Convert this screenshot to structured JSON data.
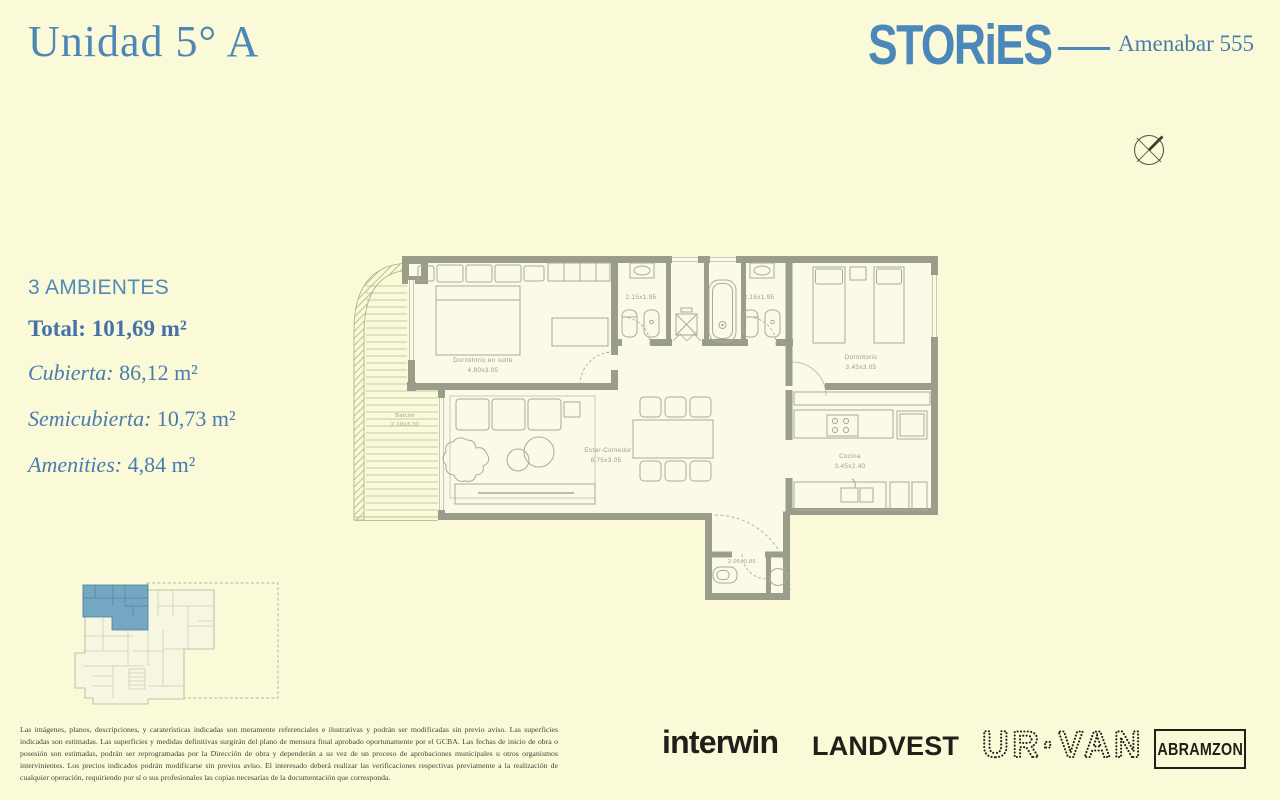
{
  "header": {
    "title": "Unidad 5° A",
    "brand": "STORiES",
    "project": "Amenabar 555"
  },
  "specs": {
    "rooms_label": "3 AMBIENTES",
    "total_label": "Total:",
    "total_value": "101,69 m²",
    "items": [
      {
        "label": "Cubierta:",
        "value": "86,12 m²"
      },
      {
        "label": "Semicubierta:",
        "value": "10,73 m²"
      },
      {
        "label": "Amenities:",
        "value": "4,84 m²"
      }
    ]
  },
  "floorplan": {
    "labels": {
      "master": {
        "name": "Dormitorio en suite",
        "dims": "4.80x3.05"
      },
      "bedroom2": {
        "name": "Dormitorio",
        "dims": "3.45x3.05"
      },
      "living": {
        "name": "Estar-Comedor",
        "dims": "8.75x3.05"
      },
      "kitchen": {
        "name": "Cocina",
        "dims": "3.45x2.40"
      },
      "balcony": {
        "name": "Balcón",
        "dims": "2.10x3.30"
      },
      "bath1": {
        "dims": "2.15x1.95"
      },
      "bath2": {
        "dims": "2.15x1.95"
      },
      "toilette": {
        "dims": "2.05x0.85"
      }
    }
  },
  "disclaimer": "Las imágenes, planos, descripciones, y caraterísticas indicadas son meramente referenciales e ilustrativas y podrán ser modificadas sin previo aviso. Las superficies indicadas son estimadas. Las superficies y medidas definitivas surgirán del plano de mensura final aprobado oportunamente por el GCBA. Las fechas de inicio de obra o posesión son estimadas, podrán ser reprogramadas por la Dirección de obra y dependerán a su vez de un proceso de aprobaciones municipales u otros organismos intervinientes. Los precios indicados podrán modificarse sin previos aviso. El interesado deberá realizar las verificaciones respectivas previamente a la realización de cualquier operación, requiriendo por sí o sus profesionales las copias necesarias de la documentación que corresponda.",
  "footer": {
    "logos": [
      {
        "name": "interwin"
      },
      {
        "name": "LANDVEST"
      },
      {
        "name": "UR·VANG"
      },
      {
        "name": "ABRAMZON"
      }
    ]
  },
  "colors": {
    "background": "#fafad9",
    "accent_blue": "#4e86b5",
    "logo_blue": "#4c87ba",
    "wall": "#9a9d89",
    "plan_line": "#a9ab96",
    "keyplan_highlight": "#74a7c1",
    "ink": "#20201a"
  }
}
